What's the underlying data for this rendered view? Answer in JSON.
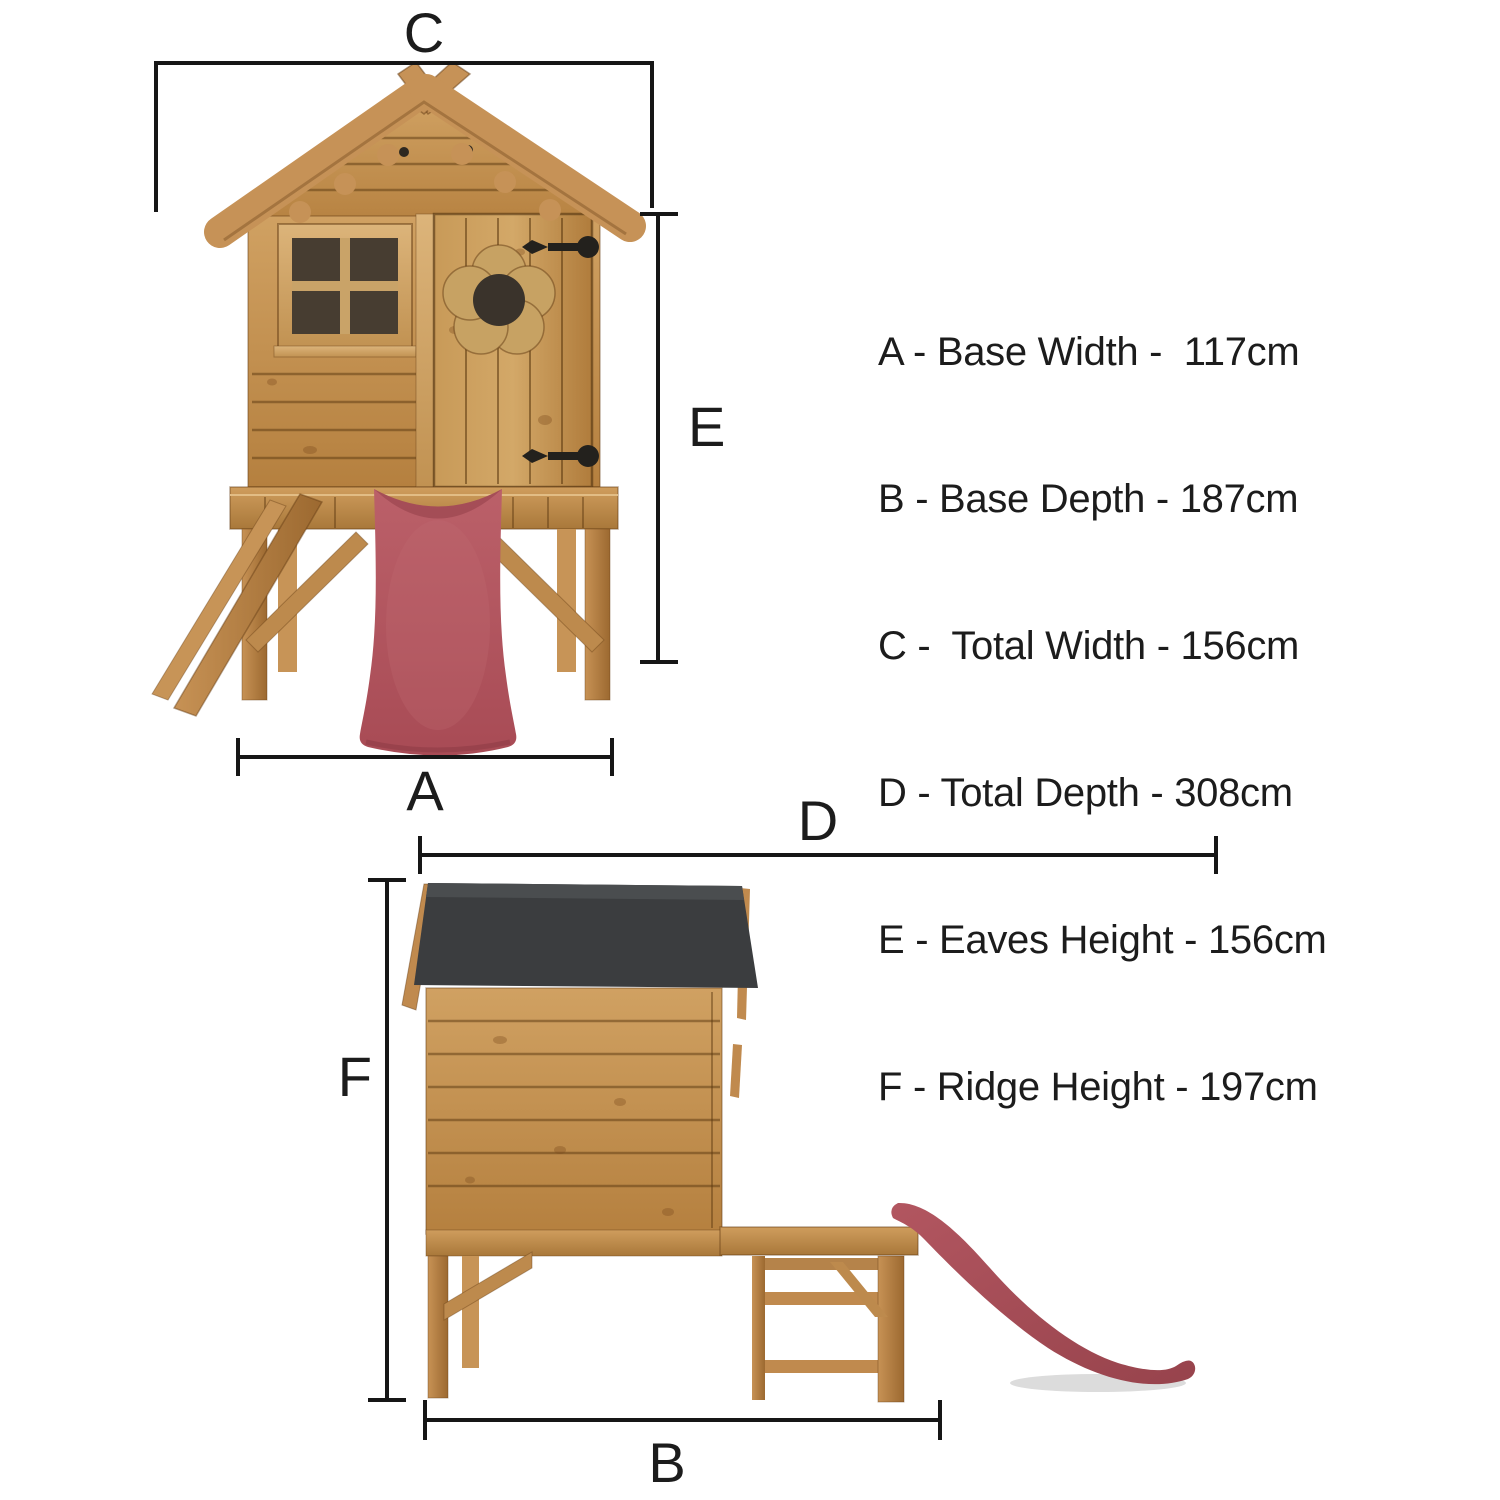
{
  "page": {
    "background": "#ffffff"
  },
  "legend": {
    "items": [
      {
        "letter": "A",
        "name": "Base Width",
        "value": "117cm",
        "text": "A - Base Width -  117cm"
      },
      {
        "letter": "B",
        "name": "Base Depth",
        "value": "187cm",
        "text": "B - Base Depth - 187cm"
      },
      {
        "letter": "C",
        "name": "Total Width",
        "value": "156cm",
        "text": "C -  Total Width - 156cm"
      },
      {
        "letter": "D",
        "name": "Total Depth",
        "value": "308cm",
        "text": "D - Total Depth - 308cm"
      },
      {
        "letter": "E",
        "name": "Eaves Height",
        "value": "156cm",
        "text": "E - Eaves Height - 156cm"
      },
      {
        "letter": "F",
        "name": "Ridge Height",
        "value": "197cm",
        "text": "F - Ridge Height - 197cm"
      }
    ]
  },
  "views": {
    "front": {
      "dim_top": "C",
      "dim_right": "E",
      "dim_bottom": "A"
    },
    "side": {
      "dim_top": "D",
      "dim_left": "F",
      "dim_bottom": "B"
    }
  },
  "colors": {
    "wood": "#c69257",
    "wood_dark": "#9c6930",
    "wood_frame": "#d2a768",
    "roof_felt": "#3b3d3f",
    "slide_red": "#b05058",
    "window_pane": "#473d31",
    "hinge_black": "#23211d",
    "dimension_line": "#161616",
    "text": "#1c1c1c",
    "background": "#ffffff"
  }
}
